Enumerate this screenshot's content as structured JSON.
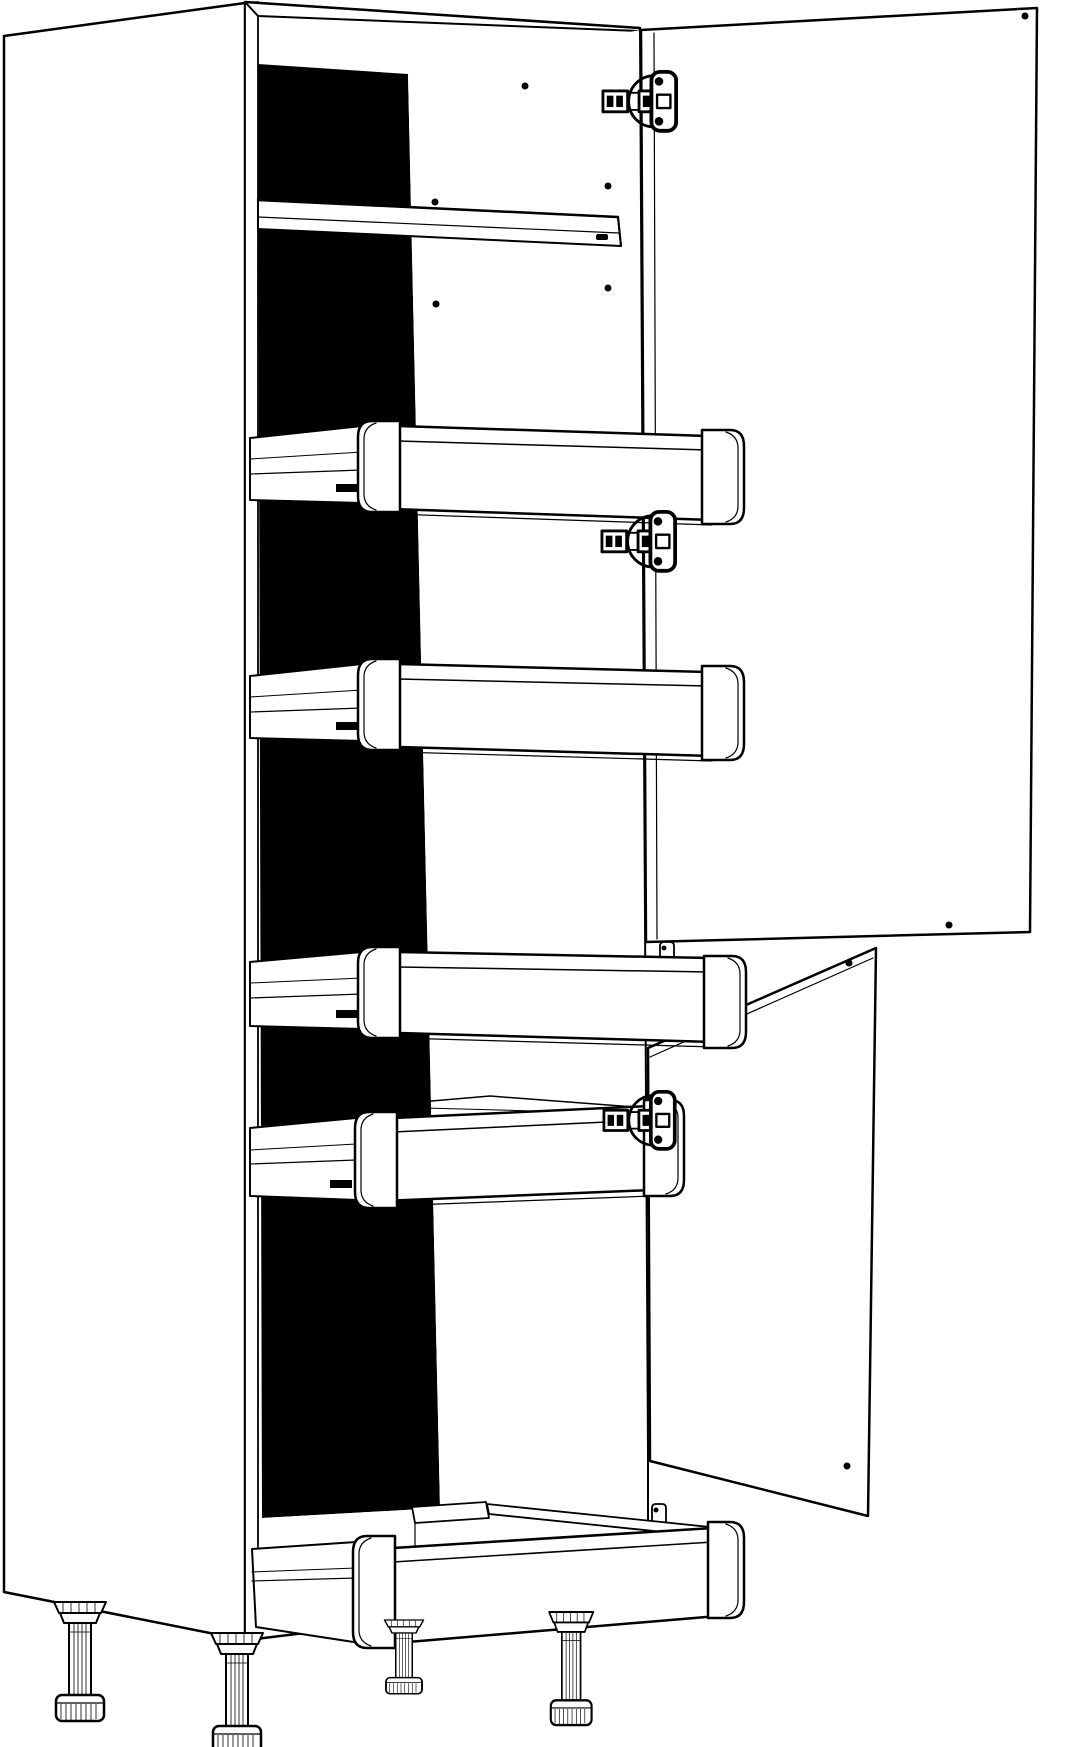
{
  "figure": {
    "title": "Tall larder cabinet - technical line drawing",
    "type": "technical line drawing",
    "colors": {
      "background": "#ffffff",
      "line": "#000000",
      "back_panel": "#000000",
      "surface": "#ffffff"
    },
    "counts": {
      "doors": 2,
      "drawers": 5,
      "hinges": 3,
      "adjustable_feet": 4,
      "shelves": 1,
      "screw_holes": 9
    },
    "parts": {
      "carcass": {
        "label": "Cabinet carcass"
      },
      "left_panel": {
        "label": "Left side panel"
      },
      "top_panel": {
        "label": "Top panel"
      },
      "right_panel": {
        "label": "Right side panel - interior face"
      },
      "back_panel": {
        "label": "Back panel"
      },
      "bottom_panel": {
        "label": "Bottom panel with drawer runners"
      },
      "shelf": {
        "label": "Fixed shelf"
      },
      "shelf_pin": {
        "label": "Shelf support pin"
      },
      "pin_holes": {
        "label": "Shelf pin holes"
      },
      "upper_door": {
        "label": "Upper door, open"
      },
      "lower_door": {
        "label": "Lower door, open"
      },
      "door_screw_holes": {
        "label": "Door fixing holes"
      },
      "drawer_1": {
        "label": "Pull-out drawer 1, top"
      },
      "drawer_2": {
        "label": "Pull-out drawer 2"
      },
      "drawer_3": {
        "label": "Pull-out drawer 3"
      },
      "drawer_4": {
        "label": "Pull-out drawer 4"
      },
      "drawer_5": {
        "label": "Deep pull-out drawer 5, bottom"
      },
      "drawer_bracket": {
        "label": "Drawer rear fixing bracket"
      },
      "hinge_top": {
        "label": "Concealed cup hinge - upper door top"
      },
      "hinge_middle": {
        "label": "Concealed cup hinge - upper door bottom"
      },
      "hinge_lower": {
        "label": "Concealed cup hinge - lower door top"
      },
      "foot_1": {
        "label": "Adjustable foot - rear left"
      },
      "foot_2": {
        "label": "Adjustable foot - front left"
      },
      "foot_3": {
        "label": "Adjustable foot - rear right"
      },
      "foot_4": {
        "label": "Adjustable foot - front right"
      }
    }
  }
}
